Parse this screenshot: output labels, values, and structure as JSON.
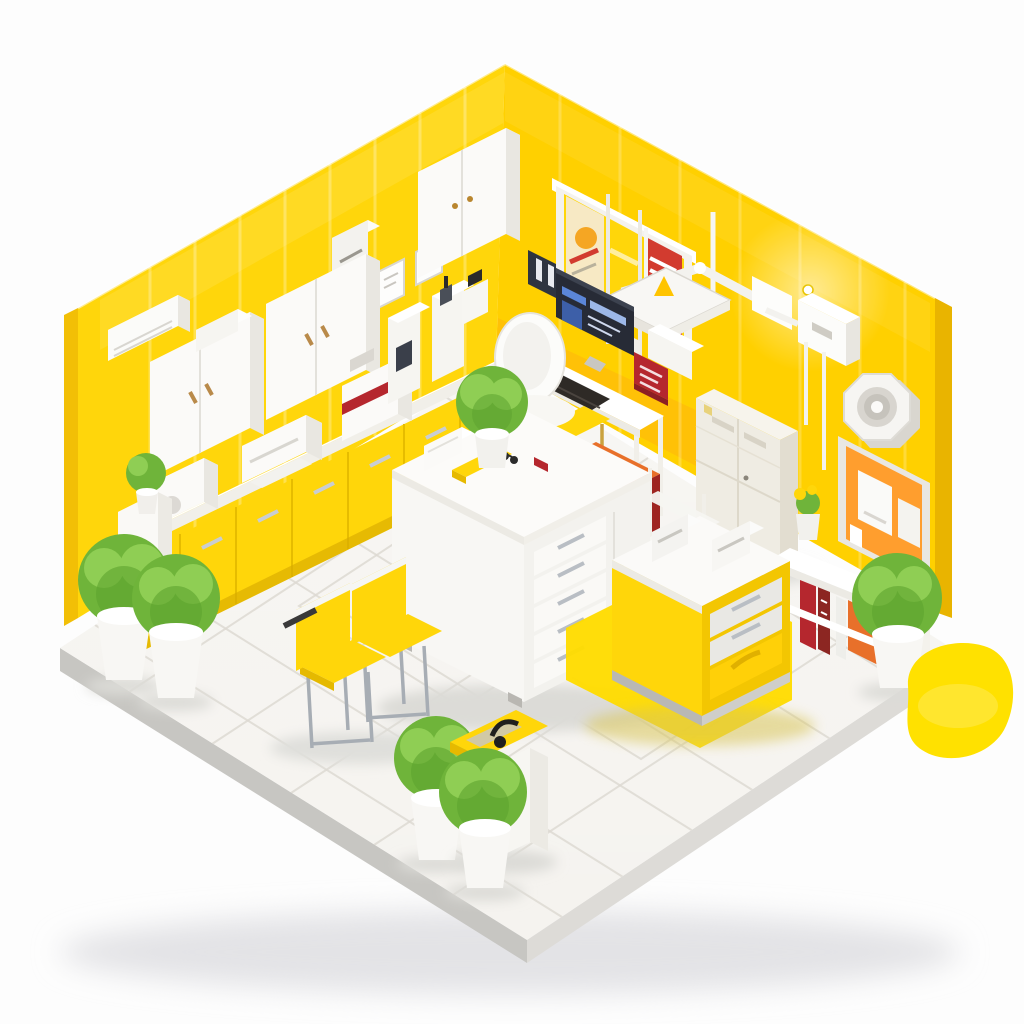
{
  "scene": {
    "title": "Isometric 3D render of a yellow clinic room with white furniture and plants",
    "style": "isometric-room-illustration",
    "background": "#FDFDFD"
  },
  "palette": {
    "wall_left": "#FFD60B",
    "wall_right": "#FFD000",
    "wall_side_left": "#F2BF06",
    "wall_side_right": "#E9B400",
    "orange_band": "#FF8F1F",
    "floor_tile": "#F5F3EF",
    "floor_edge_dark": "#C7C6C2",
    "floor_edge_light": "#DDDBD7",
    "grout": "#DDD9D2",
    "furniture_white": "#FAF9F6",
    "furniture_shade": "#E9E7E1",
    "counter_yellow": "#FFD60A",
    "counter_yellow_deep": "#E6B900",
    "island_yellow": "#FFD60A",
    "mat_yellow": "#FFDC00",
    "blob_yellow": "#FFE100",
    "accent_red": "#B5272E",
    "cart_red": "#C8342F",
    "cart_orange": "#E8702A",
    "board_orange": "#FF9E2E",
    "cream": "#EFECE3",
    "plant_green": "#6FB43A",
    "plant_green_light": "#8FCE54",
    "chrome": "#A7ADB4",
    "screen_dark": "#272B36",
    "screen_blue": "#5B86D8",
    "handle_wood": "#B98A4A"
  },
  "objects": [
    {
      "id": "left-wall",
      "label": "yellow wall left"
    },
    {
      "id": "right-wall",
      "label": "yellow wall right"
    },
    {
      "id": "floor-platform",
      "label": "white tiled floor platform"
    },
    {
      "id": "air-conditioner",
      "label": "wall air conditioner"
    },
    {
      "id": "paper-dispenser",
      "label": "wall paper dispenser"
    },
    {
      "id": "wall-frames",
      "label": "small wall frames"
    },
    {
      "id": "wall-cabinets",
      "label": "white wall cabinets"
    },
    {
      "id": "corner-wall-cabinet",
      "label": "corner wall cabinet"
    },
    {
      "id": "poster-display-case",
      "label": "poster display case"
    },
    {
      "id": "wall-file-holder",
      "label": "dark wall file holder"
    },
    {
      "id": "dental-arm-tray",
      "label": "wall equipment arm with tray"
    },
    {
      "id": "equipment-box",
      "label": "wall equipment box"
    },
    {
      "id": "wall-clock-fan",
      "label": "octagonal wall clock"
    },
    {
      "id": "pinboard",
      "label": "orange pinboard with dispensers"
    },
    {
      "id": "left-counter",
      "label": "yellow base cabinets with white countertop"
    },
    {
      "id": "counter-devices",
      "label": "white lab machines on counter"
    },
    {
      "id": "desk",
      "label": "white desk with monitor"
    },
    {
      "id": "office-chair",
      "label": "white office chair"
    },
    {
      "id": "side-chair-yellow",
      "label": "yellow stool at desk"
    },
    {
      "id": "red-drawer-cart",
      "label": "red drawer cart"
    },
    {
      "id": "wire-trolley",
      "label": "white utility trolley"
    },
    {
      "id": "tall-cream-cabinet",
      "label": "tall cream storage cabinet"
    },
    {
      "id": "wall-shelf-books",
      "label": "low shelf with red books"
    },
    {
      "id": "center-island",
      "label": "white island with drawers"
    },
    {
      "id": "yellow-island",
      "label": "yellow island with devices"
    },
    {
      "id": "arrow-mat",
      "label": "yellow arrow floor mat"
    },
    {
      "id": "chairs-pair",
      "label": "two yellow chairs"
    },
    {
      "id": "magazine-rack",
      "label": "small rack with yellow tray"
    },
    {
      "id": "plants",
      "label": "green potted plants"
    },
    {
      "id": "paint-blob",
      "label": "yellow paint blob at floor edge"
    }
  ]
}
